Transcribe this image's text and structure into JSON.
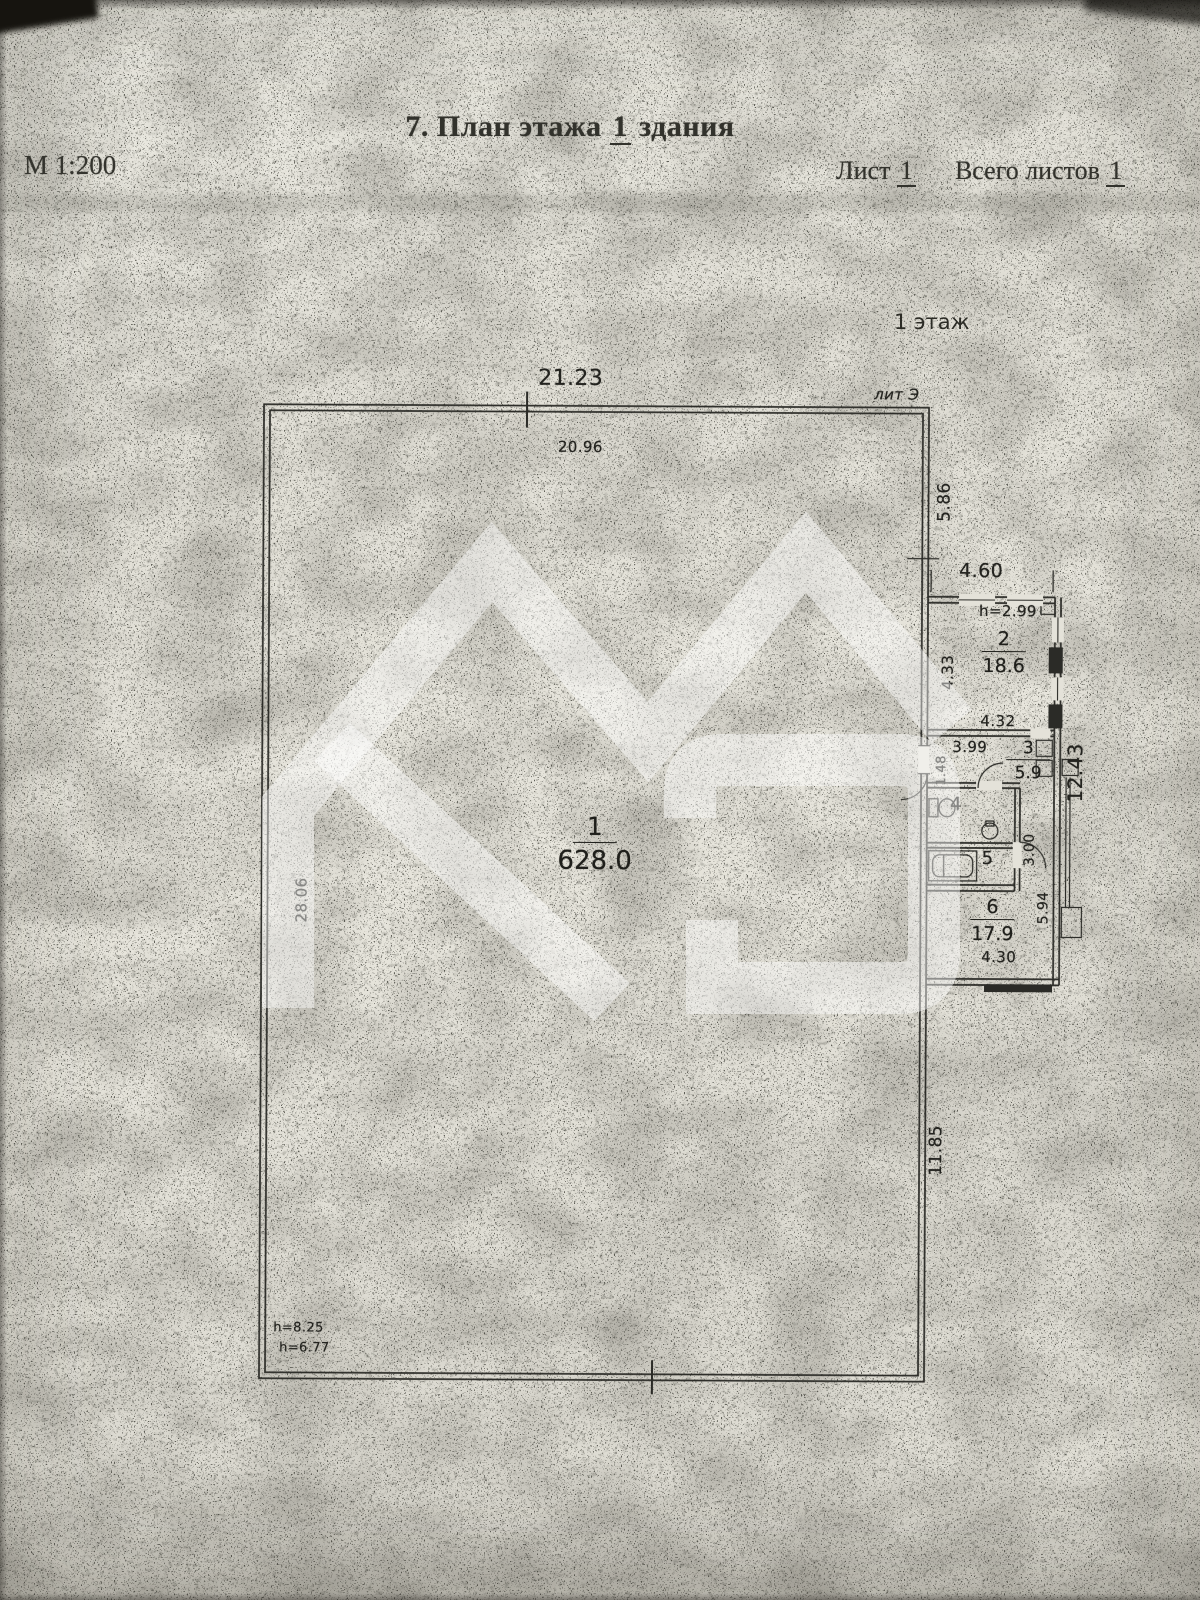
{
  "page": {
    "title_prefix": "7. План этажа",
    "title_number": "1",
    "title_suffix": "здания",
    "scale": "М 1:200",
    "sheet_label": "Лист",
    "sheet_number": "1",
    "total_label": "Всего листов",
    "total_number": "1",
    "floor_label": "1 этаж",
    "building_liter": "лит Э"
  },
  "plan": {
    "rooms": {
      "r1": {
        "number": "1",
        "area": "628.0"
      },
      "r2": {
        "number": "2",
        "area": "18.6",
        "height": "h=2.99"
      },
      "r3": {
        "number": "3",
        "area": "5.9"
      },
      "r4": {
        "number": "4"
      },
      "r5": {
        "number": "5"
      },
      "r6": {
        "number": "6",
        "area": "17.9"
      }
    },
    "dims": {
      "top_outer": "21.23",
      "top_inner": "20.96",
      "right_upper": "5.86",
      "annex_width": "4.60",
      "room2_left": "4.33",
      "room2_bottom": "4.32",
      "room3_width": "3.99",
      "room3_left": "1.48",
      "annex_right": "12.43",
      "mid_height": "3.00",
      "room6_right": "5.94",
      "room6_bottom": "4.30",
      "left_inner": "28.06",
      "right_lower": "11.85",
      "height_note_a": "h=8.25",
      "height_note_b": "h=6.77"
    }
  },
  "colors": {
    "paper": "#e4e2d9",
    "ink": "#2b2b27",
    "watermark": "rgba(255,255,255,0.45)"
  }
}
